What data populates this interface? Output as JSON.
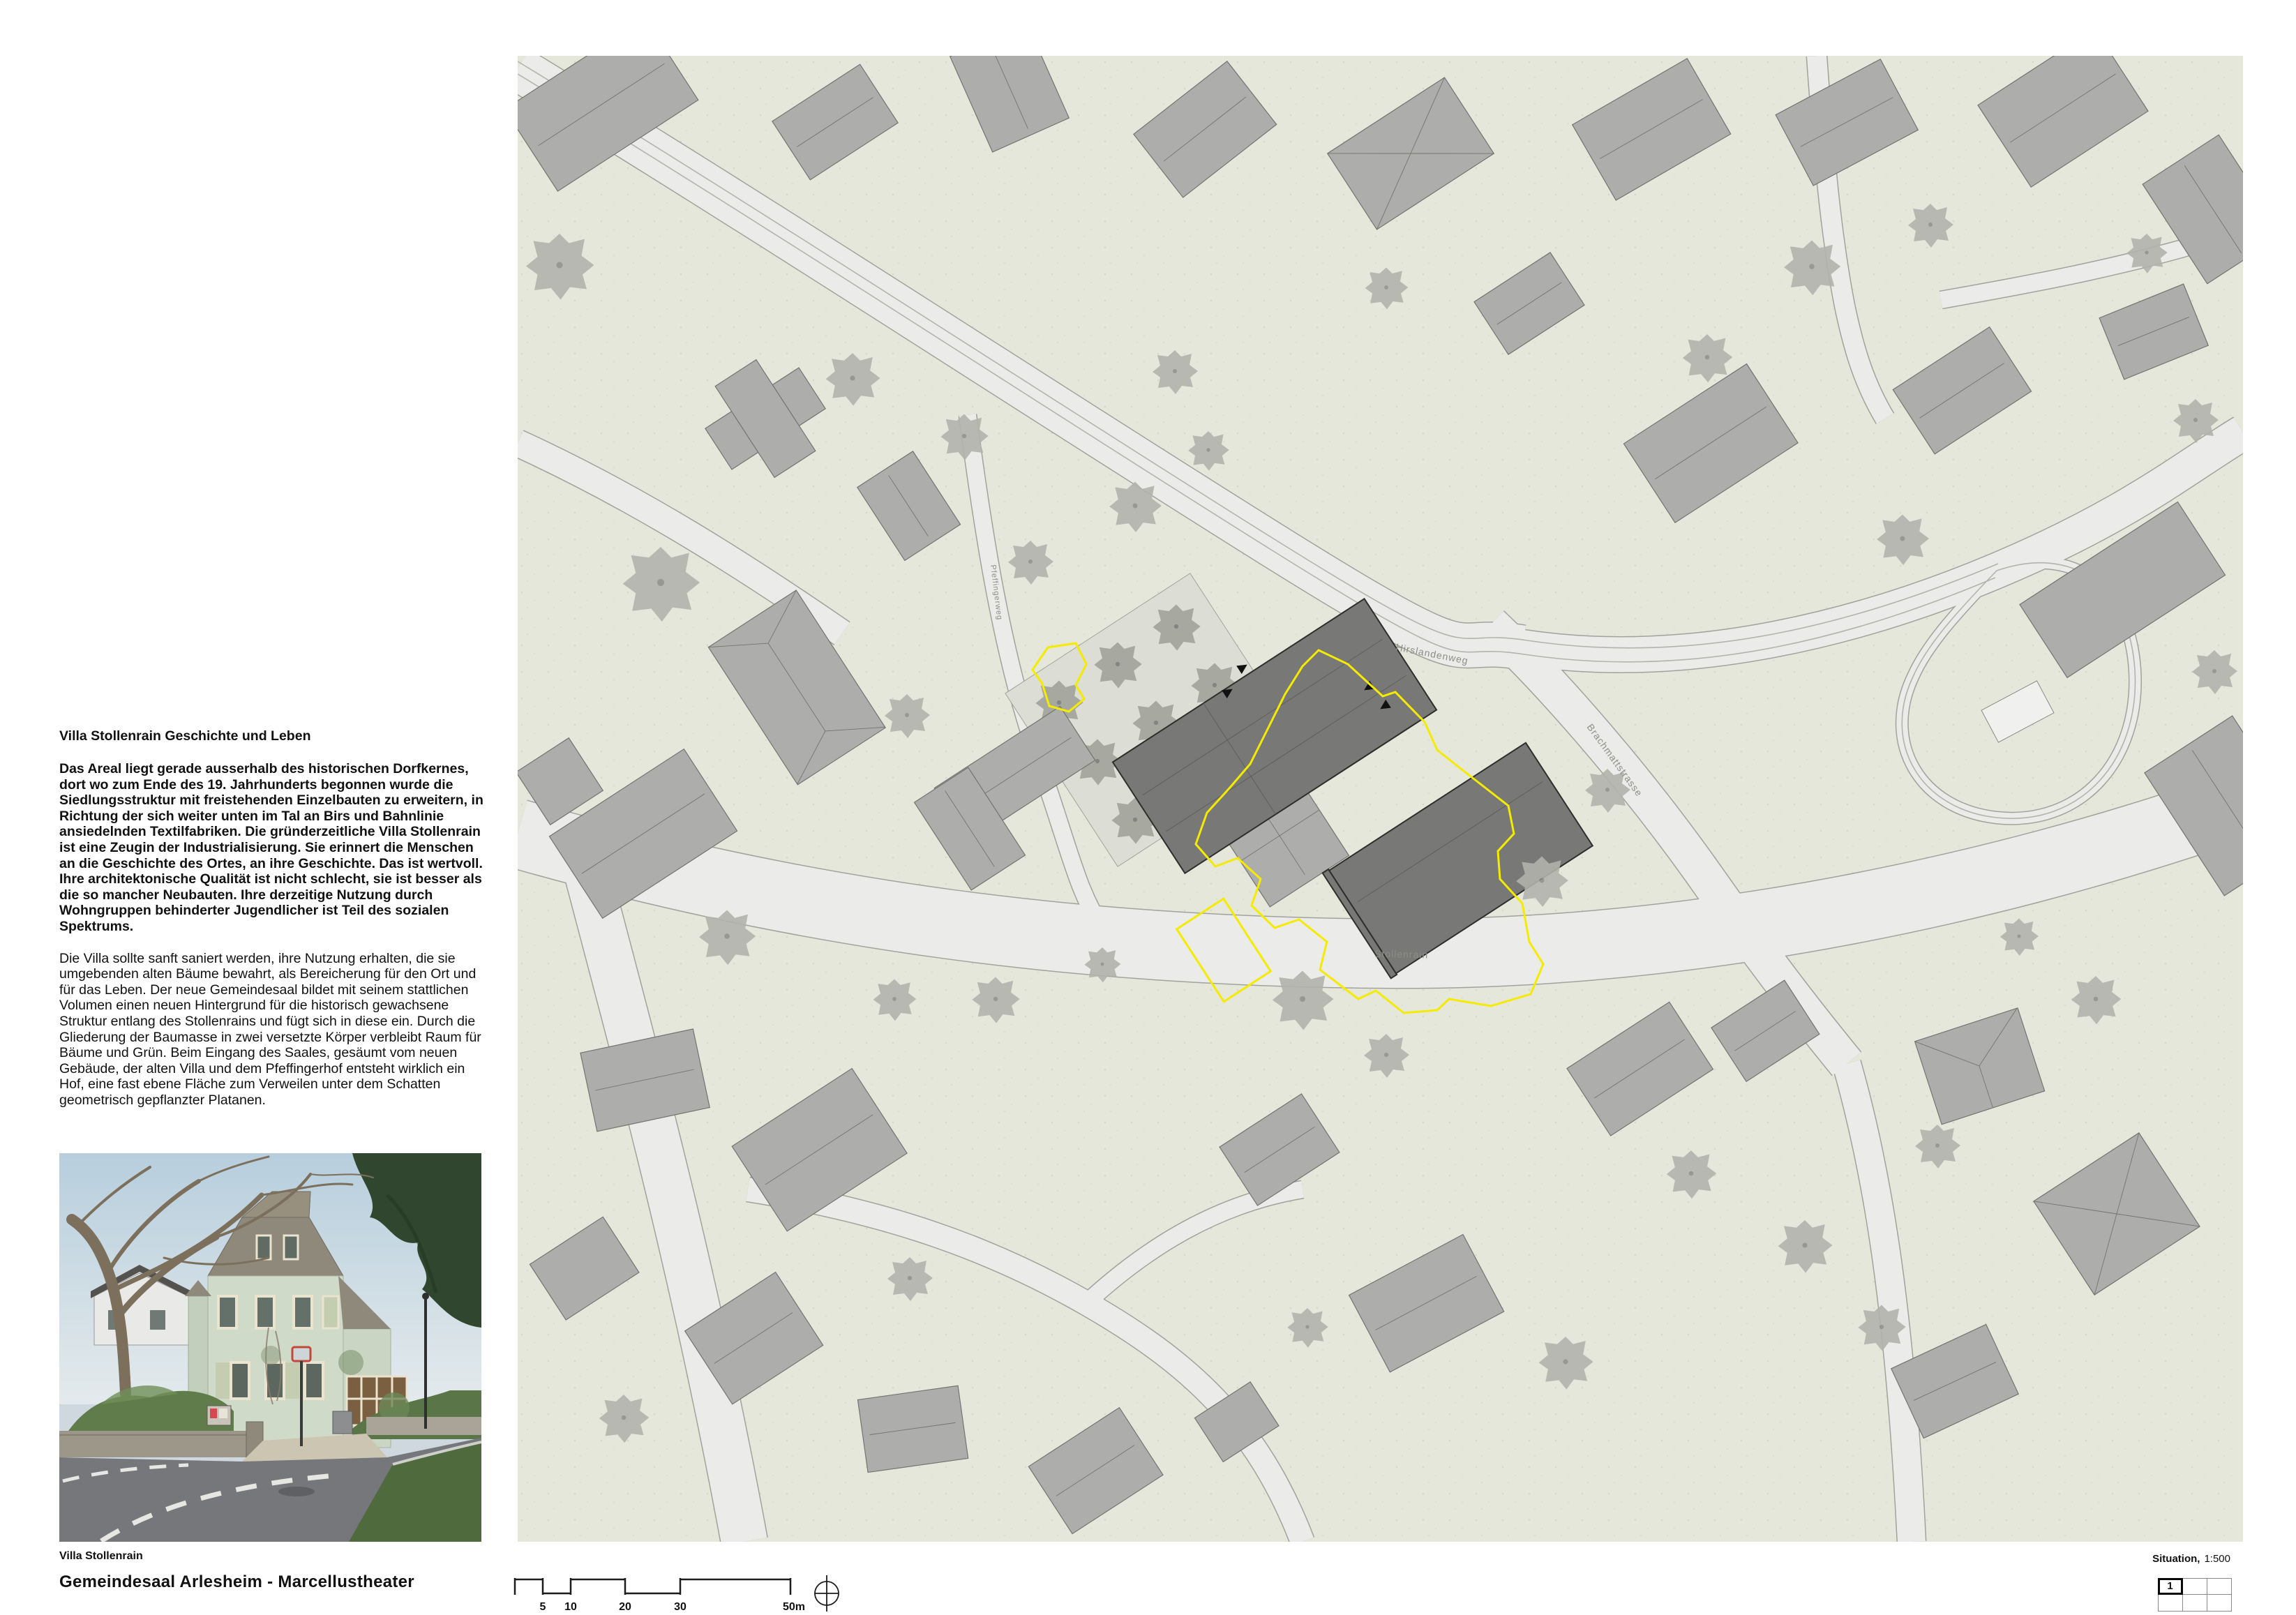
{
  "essay": {
    "title": "Villa Stollenrain  Geschichte und Leben",
    "para_bold": "Das Areal liegt gerade ausserhalb des historischen Dorfkernes, dort wo zum Ende des 19. Jahrhunderts begonnen wurde die Siedlungsstruktur mit freistehenden Einzelbauten zu erweitern, in Richtung der sich weiter unten im Tal an Birs und Bahnlinie ansiedelnden Textilfabriken. Die gründerzeitliche Villa Stollenrain ist eine Zeugin der Industrialisierung. Sie erinnert die Menschen an die Geschichte des Ortes, an ihre Geschichte. Das ist wertvoll. Ihre architektonische Qualität ist nicht schlecht, sie ist besser als die so mancher Neubauten. Ihre derzeitige Nutzung durch Wohngruppen behinderter Jugendlicher ist Teil des sozialen Spektrums.",
    "para_regular": "Die Villa sollte sanft saniert werden, ihre Nutzung erhalten, die sie umgebenden alten Bäume bewahrt, als Bereicherung für den Ort und für das Leben. Der neue Gemeindesaal bildet mit seinem stattlichen Volumen einen neuen Hintergrund für die historisch gewachsene Struktur entlang des Stollenrains und fügt sich in diese ein. Durch die Gliederung der Baumasse in zwei versetzte Körper verbleibt Raum für Bäume und Grün. Beim Eingang des Saales, gesäumt vom neuen Gebäude, der alten Villa und dem Pfeffingerhof entsteht wirklich ein Hof, eine fast ebene Fläche zum Verweilen unter dem Schatten geometrisch gepflanzter Platanen."
  },
  "photo": {
    "caption": "Villa Stollenrain"
  },
  "project": {
    "title": "Gemeindesaal Arlesheim - Marcellustheater"
  },
  "plan": {
    "streets": {
      "hirslandenweg": "Hirslandenweg",
      "brachmattstrasse": "Brachmattstrasse",
      "stollenrain": "Stollenrain",
      "pfeffingerweg": "Pfeffingerweg"
    },
    "colors": {
      "paper": "#e6e7db",
      "road": "#ebebe9",
      "building": "#adadab",
      "new_building": "#787876",
      "site_boundary": "#f4eb00",
      "tree": "#b2b3ac"
    }
  },
  "footer": {
    "plan_bold": "Situation,",
    "plan_scale": "1:500",
    "scale_labels": [
      "5",
      "10",
      "20",
      "30",
      "50m"
    ],
    "page_cell": "1"
  }
}
